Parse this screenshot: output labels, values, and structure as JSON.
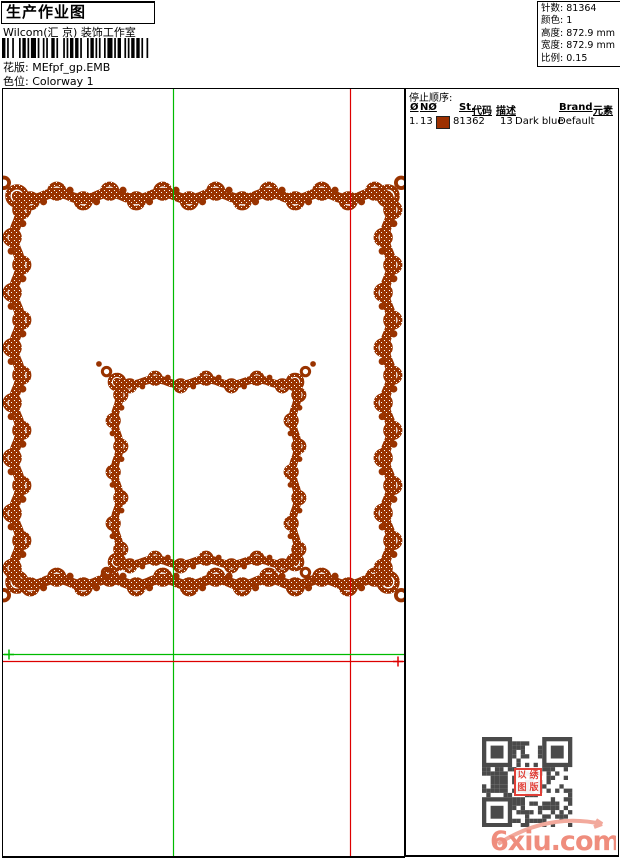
{
  "header": {
    "title": "生产作业图",
    "studio": "Wilcom(汇 京) 装饰工作室",
    "pattern_label": "花版:",
    "pattern_value": "MEfpf_gp.EMB",
    "colorway_label": "色位:",
    "colorway_value": "Colorway 1"
  },
  "info": {
    "stitches_label": "针数:",
    "stitches": "81364",
    "colors_label": "颜色:",
    "colors": "1",
    "height_label": "高度:",
    "height": "872.9 mm",
    "width_label": "宽度:",
    "width": "872.9 mm",
    "scale_label": "比例:",
    "scale": "0.15"
  },
  "stop_sequence": {
    "title": "停止顺序:",
    "columns": [
      "Ø",
      "NØ",
      "St.",
      "代码",
      "描述",
      "Brand",
      "元素"
    ],
    "rows": [
      {
        "seq": "1.",
        "needle": "13",
        "swatch_color": "#9C3000",
        "stitches": "81362",
        "code": "13",
        "description": "Dark blue",
        "brand": "Default",
        "elements": ""
      }
    ]
  },
  "design": {
    "thread_color": "#993300",
    "guide_green": "#00BB00",
    "guide_red": "#DD0000",
    "frames": "two concentric ornate scroll square borders",
    "start_marker": "green cross at left end of green baseline",
    "end_marker": "red cross at right end of red baseline"
  },
  "qr": {
    "color": "#4A4A4A",
    "stamp_chars": [
      "以",
      "绣",
      "图",
      "版"
    ]
  },
  "watermark": {
    "site": "6xiu.com",
    "color": "#EF8D7D"
  }
}
